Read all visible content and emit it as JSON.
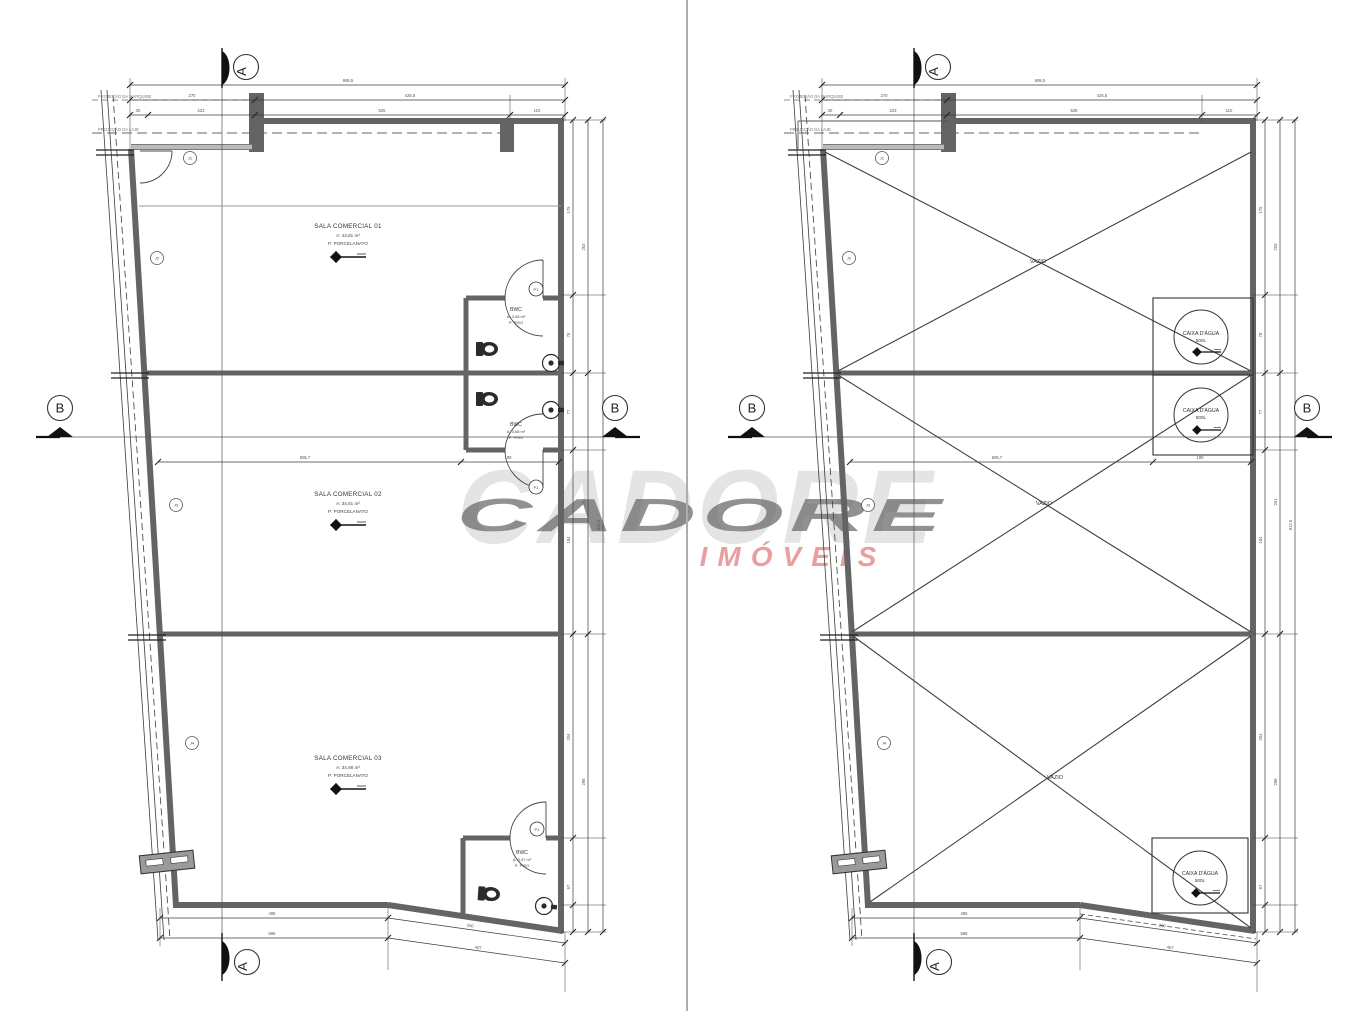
{
  "watermark": {
    "brand": "CADORE",
    "subtitle": "IMÓVEIS"
  },
  "section_markers": {
    "a": "A",
    "b": "B"
  },
  "projection_labels": [
    "PROJEÇÃO DA MARQUISE",
    "PROJEÇÃO DA LAJE"
  ],
  "left_plan": {
    "rooms": [
      {
        "name": "SALA COMERCIAL 01",
        "area": "A: 43,81 m²",
        "floor": "P: PORCELANATO"
      },
      {
        "name": "SALA COMERCIAL 02",
        "area": "A: 34,61 m²",
        "floor": "P: PORCELANATO"
      },
      {
        "name": "SALA COMERCIAL 03",
        "area": "A: 34,68 m²",
        "floor": "P: PORCELANATO"
      }
    ],
    "bwcs": [
      {
        "name": "BWC",
        "area": "A: 3,08 m²",
        "floor": "P: PISO"
      },
      {
        "name": "BWC",
        "area": "A: 3,08 m²",
        "floor": "P: PISO"
      },
      {
        "name": "BWC",
        "area": "A: 3,47 m²",
        "floor": "P: PISO"
      }
    ],
    "door_tags": [
      "P1",
      "P1",
      "P1"
    ]
  },
  "right_plan": {
    "voids": [
      "VAZIO",
      "VAZIO",
      "VAZIO"
    ],
    "tanks": [
      {
        "name": "CAIXA D'ÁGUA",
        "capacity": "500L"
      },
      {
        "name": "CAIXA D'ÁGUA",
        "capacity": "500L"
      },
      {
        "name": "CAIXA D'ÁGUA",
        "capacity": "500L"
      }
    ]
  },
  "dims_common": [
    {
      "x": 348,
      "y": 82,
      "t": "695,5"
    },
    {
      "x": 192,
      "y": 97,
      "t": "270"
    },
    {
      "x": 410,
      "y": 97,
      "t": "425,5"
    },
    {
      "x": 138,
      "y": 112,
      "t": "30"
    },
    {
      "x": 201,
      "y": 112,
      "t": "223"
    },
    {
      "x": 382,
      "y": 112,
      "t": "525"
    },
    {
      "x": 537,
      "y": 112,
      "t": "110"
    },
    {
      "x": 570,
      "y": 210,
      "t": "175",
      "r": -90
    },
    {
      "x": 570,
      "y": 335,
      "t": "78",
      "r": -90
    },
    {
      "x": 570,
      "y": 412,
      "t": "77",
      "r": -90
    },
    {
      "x": 570,
      "y": 540,
      "t": "184",
      "r": -90
    },
    {
      "x": 570,
      "y": 737,
      "t": "204",
      "r": -90
    },
    {
      "x": 570,
      "y": 887,
      "t": "97",
      "r": -90
    },
    {
      "x": 585,
      "y": 247,
      "t": "253",
      "r": -90
    },
    {
      "x": 585,
      "y": 502,
      "t": "261",
      "r": -90
    },
    {
      "x": 585,
      "y": 782,
      "t": "298",
      "r": -90
    },
    {
      "x": 600,
      "y": 525,
      "t": "812,5",
      "r": -90
    },
    {
      "x": 272,
      "y": 915,
      "t": "495"
    },
    {
      "x": 470,
      "y": 927,
      "t": "350",
      "r": 8
    },
    {
      "x": 272,
      "y": 935,
      "t": "586"
    },
    {
      "x": 478,
      "y": 949,
      "t": "407",
      "r": 8
    },
    {
      "x": 305,
      "y": 459,
      "t": "605,7"
    },
    {
      "x": 508,
      "y": 459,
      "t": "190"
    }
  ],
  "tags_common": [
    {
      "x": 190,
      "y": 158,
      "t": "J1"
    },
    {
      "x": 157,
      "y": 258,
      "t": "J2"
    },
    {
      "x": 176,
      "y": 505,
      "t": "J3"
    },
    {
      "x": 192,
      "y": 743,
      "t": "J4"
    }
  ]
}
